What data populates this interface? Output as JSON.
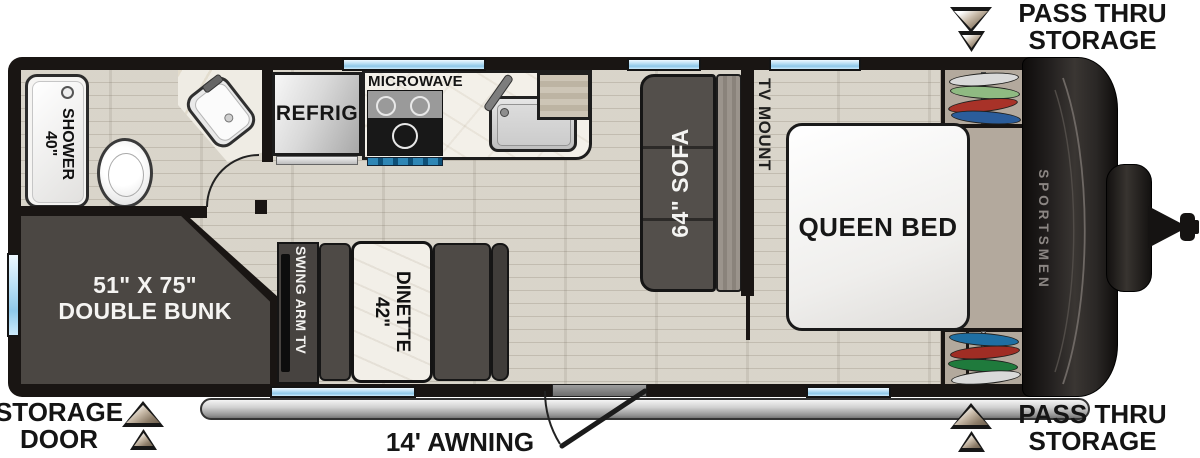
{
  "brand": "SPORTSMEN",
  "exterior": {
    "pass_thru_top": {
      "line1": "PASS THRU",
      "line2": "STORAGE"
    },
    "pass_thru_bottom": {
      "line1": "PASS THRU",
      "line2": "STORAGE"
    },
    "storage_door": {
      "line1": "STORAGE",
      "line2": "DOOR"
    },
    "awning_label": "14' AWNING"
  },
  "rooms": {
    "bathroom": {
      "shower_line1": "40\"",
      "shower_line2": "SHOWER"
    },
    "kitchen": {
      "refrigerator": "REFRIG",
      "microwave": "MICROWAVE"
    },
    "living": {
      "sofa": "64\" SOFA",
      "tv_mount": "TV MOUNT",
      "swing_arm_tv": "SWING ARM TV",
      "dinette_line1": "42\"",
      "dinette_line2": "DINETTE"
    },
    "bunk": {
      "line1": "51\" X 75\"",
      "line2": "DOUBLE BUNK"
    },
    "bedroom": {
      "bed": "QUEEN BED"
    }
  },
  "colors": {
    "wall": "#191513",
    "floor_wood": "#d7d2c7",
    "furniture_dark": "#4e4a46",
    "window_glass": "#a9d6ef",
    "counter_marble": "#f3f0ea",
    "bedroom_carpet": "#b3a99d",
    "awning_gray": "#c9c9c9",
    "wardrobe_clothes_top": [
      "#d9d9d9",
      "#8fba82",
      "#a83228",
      "#2b5d9b"
    ],
    "wardrobe_clothes_bottom": [
      "#1f6fa3",
      "#a02d24",
      "#1f7a3c",
      "#d9d9d9"
    ]
  }
}
